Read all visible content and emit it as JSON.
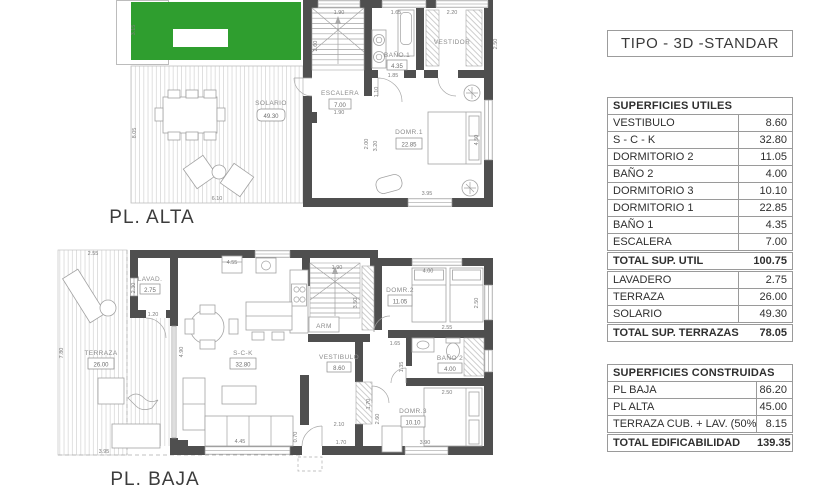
{
  "title_block": {
    "text": "TIPO - 3D -STANDAR"
  },
  "tables": {
    "utiles": {
      "header": "SUPERFICIES UTILES",
      "rows": [
        {
          "label": "VESTIBULO",
          "value": "8.60"
        },
        {
          "label": "S - C - K",
          "value": "32.80"
        },
        {
          "label": "DORMITORIO 2",
          "value": "11.05"
        },
        {
          "label": "BAÑO 2",
          "value": "4.00"
        },
        {
          "label": "DORMITORIO 3",
          "value": "10.10"
        },
        {
          "label": "DORMITORIO 1",
          "value": "22.85"
        },
        {
          "label": "BAÑO 1",
          "value": "4.35"
        },
        {
          "label": "ESCALERA",
          "value": "7.00"
        }
      ],
      "total_util": {
        "label": "TOTAL SUP. UTIL",
        "value": "100.75"
      },
      "terrace_rows": [
        {
          "label": "LAVADERO",
          "value": "2.75"
        },
        {
          "label": "TERRAZA",
          "value": "26.00"
        },
        {
          "label": "SOLARIO",
          "value": "49.30"
        }
      ],
      "total_terrazas": {
        "label": "TOTAL SUP. TERRAZAS",
        "value": "78.05"
      }
    },
    "construidas": {
      "header": "SUPERFICIES CONSTRUIDAS",
      "rows": [
        {
          "label": "PL BAJA",
          "value": "86.20"
        },
        {
          "label": "PL ALTA",
          "value": "45.00"
        },
        {
          "label": "TERRAZA CUB. + LAV. (50%)",
          "value": "8.15"
        }
      ],
      "total": {
        "label": "TOTAL EDIFICABILIDAD",
        "value": "139.35"
      }
    }
  },
  "plans": {
    "alta": {
      "title": "PL. ALTA",
      "rooms": {
        "solario": {
          "name": "SOLARIO",
          "area": "49.30"
        },
        "escalera": {
          "name": "ESCALERA",
          "area": "7.00"
        },
        "bano1": {
          "name": "BAÑO.1",
          "area": "4.35"
        },
        "vestidor": {
          "name": "VESTIDOR"
        },
        "dorm1": {
          "name": "DOMR.1",
          "area": "22.85"
        }
      },
      "dims": [
        "3.15",
        "8.05",
        "6.10",
        "1.90",
        "1.65",
        "2.20",
        "2.60",
        "2.50",
        "1.85",
        "1.90",
        "1.10",
        "2.00",
        "3.20",
        "4.50",
        "3.95"
      ]
    },
    "baja": {
      "title": "PL. BAJA",
      "rooms": {
        "lavadero": {
          "name": "LAVAD.",
          "area": "2.75"
        },
        "terraza": {
          "name": "TERRAZA",
          "area": "26.00"
        },
        "sck": {
          "name": "S-C-K",
          "area": "32.80"
        },
        "vestibulo": {
          "name": "VESTIBULO",
          "area": "8.60"
        },
        "armario": {
          "name": "ARM"
        },
        "dorm2": {
          "name": "DOMR.2",
          "area": "11.05"
        },
        "bano2": {
          "name": "BAÑO 2",
          "area": "4.00"
        },
        "dorm3": {
          "name": "DOMR.3",
          "area": "10.10"
        }
      },
      "dims": [
        "2.55",
        "7.80",
        "3.95",
        "2.30",
        "1.20",
        "4.55",
        "4.90",
        "4.45",
        "0.70",
        "1.90",
        "3.50",
        "1.65",
        "4.00",
        "2.50",
        "2.55",
        "2.50",
        "1.35",
        "2.10",
        "1.70",
        "1.70",
        "2.60",
        "3.90"
      ]
    }
  },
  "colors": {
    "roof_green": "#2f9e2f",
    "wall_gray": "#4f4f4f",
    "hatch_gray": "#d2d2d2"
  }
}
